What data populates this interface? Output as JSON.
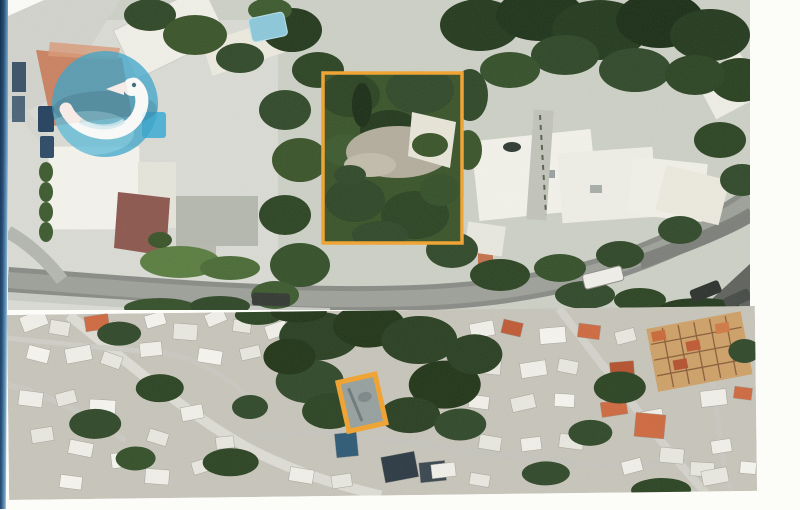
{
  "colors": {
    "page_background": "#fcfcf9",
    "binding_edge_dark": "#142f4c",
    "binding_edge_light": "#6a9bbf",
    "parcel_highlight": "#f2a32f",
    "logo_circle": "#3fa5ca",
    "logo_accent": "#8ed4e6",
    "logo_bird": "#ffffff",
    "road_gray": "#8a8c86",
    "tree_dark_green": "#243a1e",
    "tree_mid_green": "#3a5429",
    "building_white": "#f2f1e9",
    "roof_terracotta": "#c05a35",
    "roof_maroon": "#8c574d",
    "pool_blue": "#6fc0da",
    "clearing_gray": "#b3ad9d"
  },
  "panels": {
    "top": {
      "marker_shape": "rectangle",
      "marker_color": "#f2a32f"
    },
    "bottom": {
      "marker_shape": "rectangle",
      "marker_color": "#f2a32f"
    }
  }
}
